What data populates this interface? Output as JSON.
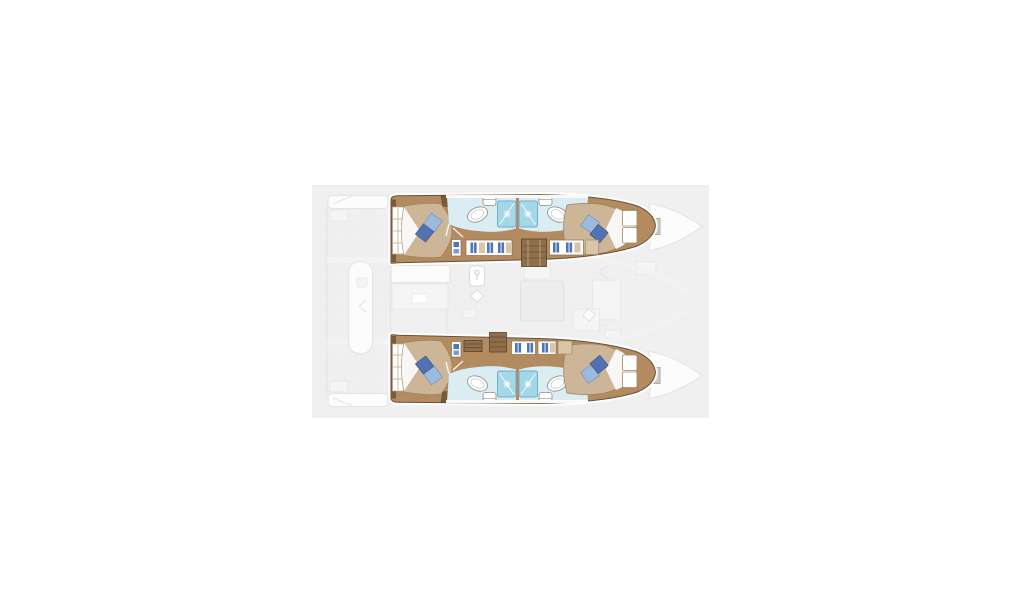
{
  "meta": {
    "title": "Catamaran yacht deck layout floor plan, top view",
    "diagram_type": "boat-floor-plan",
    "visible_text": "none"
  },
  "plan": {
    "hulls": 2,
    "cabins": 4,
    "bathrooms": 4,
    "showers": 4,
    "double_berths": 4,
    "port_hull": {
      "aft_cabin": [
        "double-bed",
        "headboard",
        "blue-pillow-dark",
        "blue-pillow-light",
        "white-blanket"
      ],
      "aft_bathroom": [
        "sink",
        "toilet",
        "shower-cabin"
      ],
      "corridor": [
        "wardrobe-lockers",
        "companionway-stairs"
      ],
      "fwd_bathroom": [
        "sink",
        "toilet",
        "shower-cabin"
      ],
      "fwd_cabin": [
        "double-bed",
        "blue-pillow-dark",
        "blue-pillow-light",
        "white-blanket",
        "bow-shelves"
      ]
    },
    "starboard_hull": {
      "aft_cabin": [
        "double-bed",
        "headboard",
        "blue-pillow-dark",
        "blue-pillow-light",
        "white-blanket"
      ],
      "aft_bathroom": [
        "sink",
        "toilet",
        "shower-cabin"
      ],
      "corridor": [
        "wardrobe-lockers",
        "companionway-stairs"
      ],
      "fwd_bathroom": [
        "sink",
        "toilet",
        "shower-cabin"
      ],
      "fwd_cabin": [
        "double-bed",
        "blue-pillow-dark",
        "blue-pillow-light",
        "white-blanket",
        "bow-shelves"
      ]
    },
    "center": [
      "aft-deck",
      "cockpit-bench",
      "swim-platforms",
      "salon-galley",
      "salon-table",
      "nav-desk",
      "bow-deck-hatches",
      "bow-tips"
    ]
  },
  "colors": {
    "page_bg": "#ffffff",
    "canvas_bg": "#f0f0f1",
    "hull_wood": "#b28b60",
    "wood_dark": "#7b5a39",
    "hull_outline": "#6a5138",
    "bed": "#cdb698",
    "pillow_dark": "#5372b3",
    "pillow_light": "#9db9de",
    "bath_floor": "#d9edf3",
    "shower": "#a4d7e8",
    "shower_edge": "#74aec8",
    "locker_blue": "#4f74b8",
    "stairs": "#8f6f4a",
    "hatch_gray": "#cbcbcb"
  }
}
